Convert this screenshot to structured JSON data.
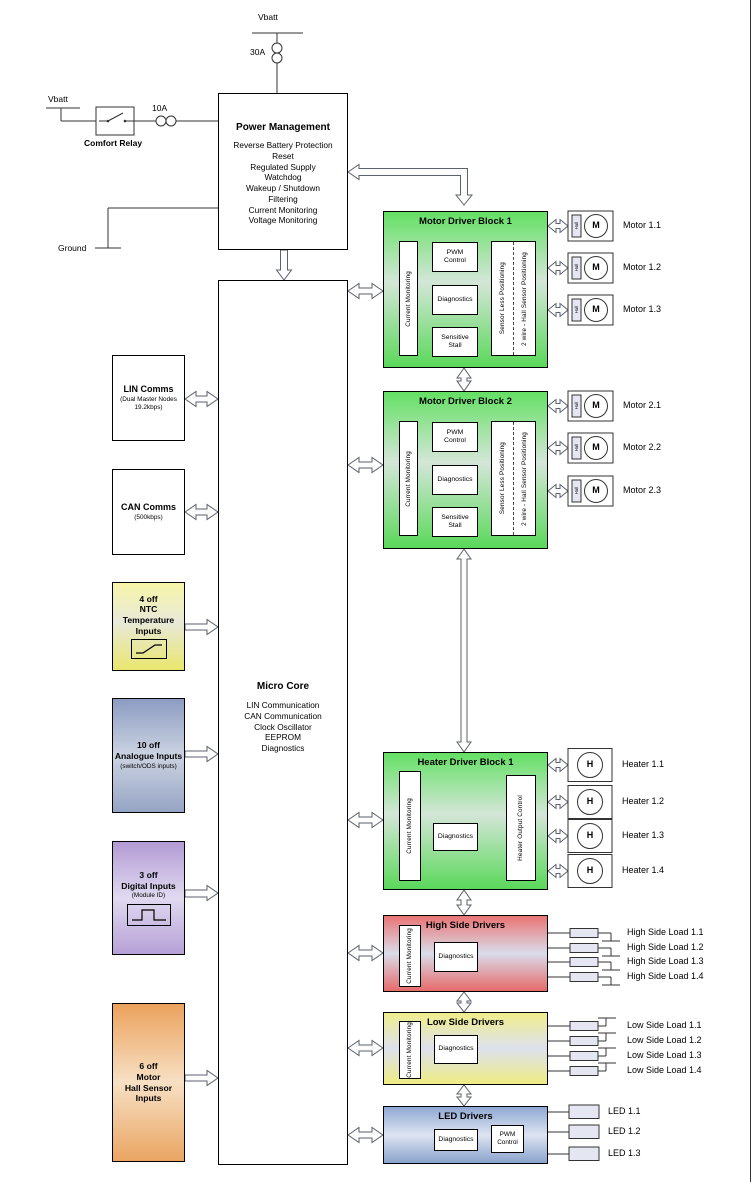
{
  "supply": {
    "vbatt_top": "Vbatt",
    "fuse_top": "30A",
    "vbatt_left": "Vbatt",
    "relay_label": "Comfort Relay",
    "fuse_left": "10A",
    "ground_label": "Ground"
  },
  "power_management": {
    "title": "Power Management",
    "features": "Reverse Battery Protection\nReset\nRegulated Supply\nWatchdog\nWakeup / Shutdown\nFiltering\nCurrent Monitoring\nVoltage Monitoring"
  },
  "micro_core": {
    "title": "Micro Core",
    "features": "LIN Communication\nCAN Communication\nClock Oscillator\nEEPROM\nDiagnostics"
  },
  "left_inputs": {
    "lin": {
      "title": "LIN Comms",
      "sub": "(Dual Master Nodes\n19.2kbps)"
    },
    "can": {
      "title": "CAN Comms",
      "sub": "(500kbps)"
    },
    "ntc": {
      "title": "4 off\nNTC\nTemperature\nInputs"
    },
    "analogue": {
      "title": "10 off\nAnalogue Inputs",
      "sub": "(switch/ODS inputs)"
    },
    "digital": {
      "title": "3 off\nDigital Inputs",
      "sub": "(Module ID)"
    },
    "hall": {
      "title": "6 off\nMotor\nHall Sensor\nInputs"
    }
  },
  "motor_driver_block_1": {
    "title": "Motor Driver Block 1",
    "current_monitoring": "Current Monitoring",
    "pwm_control": "PWM\nControl",
    "diagnostics": "Diagnostics",
    "sensitive_stall": "Sensitive\nStall",
    "sensor_less": "Sensor Less Positioning",
    "hall_positioning": "2 wire - Hall Sensor Positioning"
  },
  "motor_driver_block_2": {
    "title": "Motor Driver Block 2",
    "current_monitoring": "Current Monitoring",
    "pwm_control": "PWM\nControl",
    "diagnostics": "Diagnostics",
    "sensitive_stall": "Sensitive\nStall",
    "sensor_less": "Sensor Less Positioning",
    "hall_positioning": "2 wire - Hall Sensor Positioning"
  },
  "heater_driver_block": {
    "title": "Heater Driver Block 1",
    "current_monitoring": "Current Monitoring",
    "diagnostics": "Diagnostics",
    "output_control": "Heater Output Control"
  },
  "high_side": {
    "title": "High Side Drivers",
    "current_monitoring": "Current Monitoring",
    "diagnostics": "Diagnostics",
    "loads": [
      "High Side Load 1.1",
      "High Side Load 1.2",
      "High Side Load 1.3",
      "High Side Load 1.4"
    ]
  },
  "low_side": {
    "title": "Low Side Drivers",
    "current_monitoring": "Current Monitoring",
    "diagnostics": "Diagnostics",
    "loads": [
      "Low Side Load 1.1",
      "Low Side Load 1.2",
      "Low Side Load 1.3",
      "Low Side Load 1.4"
    ]
  },
  "led_drivers": {
    "title": "LED Drivers",
    "diagnostics": "Diagnostics",
    "pwm_control": "PWM\nControl",
    "leds": [
      "LED 1.1",
      "LED 1.2",
      "LED 1.3"
    ]
  },
  "motors": {
    "hall_tag": "Hall",
    "symbol": "M",
    "group1": [
      "Motor 1.1",
      "Motor 1.2",
      "Motor 1.3"
    ],
    "group2": [
      "Motor 2.1",
      "Motor 2.2",
      "Motor 2.3"
    ]
  },
  "heaters": {
    "symbol": "H",
    "items": [
      "Heater 1.1",
      "Heater 1.2",
      "Heater 1.3",
      "Heater 1.4"
    ]
  },
  "colors": {
    "motor_heater_block": "#5ad85a",
    "high_side_block": "#ea7474",
    "low_side_block": "#f0ee8c",
    "led_block": "#8fa8d2",
    "ntc_block": "#e9e66e",
    "analogue_block": "#8c9cc2",
    "digital_block": "#b29ad4",
    "hall_block": "#eba25c"
  }
}
